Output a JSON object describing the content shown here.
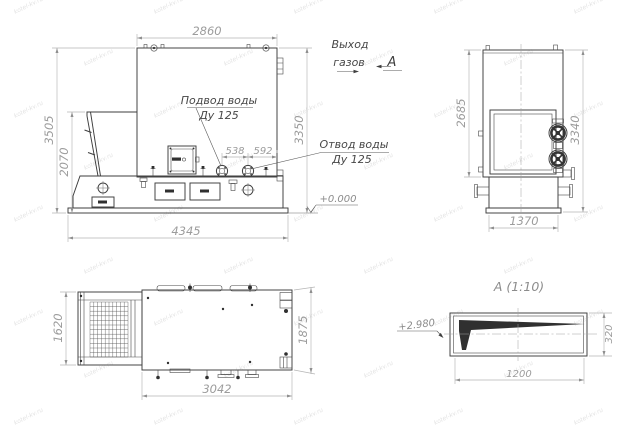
{
  "drawing": {
    "watermark": "kotel-kv.ru",
    "front_view": {
      "dim_width_top": "2860",
      "dim_height_total": "3505",
      "dim_height_hopper": "2070",
      "dim_height_right": "3350",
      "dim_flange_1": "538",
      "dim_flange_2": "592",
      "dim_base_length": "4345",
      "label_water_supply": "Подвод воды",
      "label_water_supply_dn": "Ду 125",
      "label_water_return": "Отвод воды",
      "label_water_return_dn": "Ду 125",
      "label_gas_1": "Выход",
      "label_gas_2": "газов",
      "view_marker": "А",
      "level_zero": "+0.000"
    },
    "side_view": {
      "dim_height_front": "2685",
      "dim_height_total": "3340",
      "dim_width": "1370"
    },
    "plan_view": {
      "dim_width_conveyor": "1620",
      "dim_width_body": "1875",
      "dim_length": "3042"
    },
    "detail_view": {
      "title": "А (1:10)",
      "level": "+2.980",
      "dim_length": "1200",
      "dim_height": "320"
    }
  }
}
